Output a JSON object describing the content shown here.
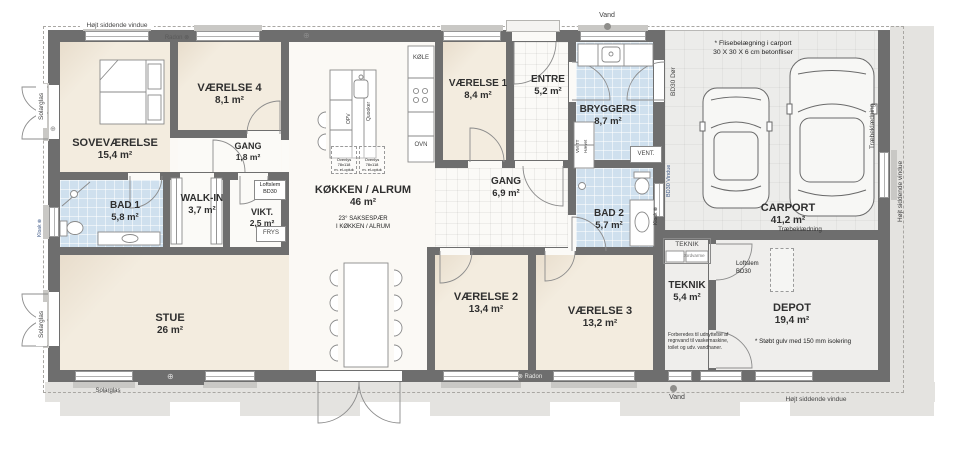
{
  "plan": {
    "rooms": [
      {
        "name": "SOVEVÆRELSE",
        "area": "15,4 m²"
      },
      {
        "name": "VÆRELSE 4",
        "area": "8,1 m²"
      },
      {
        "name": "GANG",
        "area": "1,8 m²"
      },
      {
        "name": "BAD 1",
        "area": "5,8 m²"
      },
      {
        "name": "WALK-IN",
        "area": "3,7 m²"
      },
      {
        "name": "VIKT.",
        "area": "2,5 m²"
      },
      {
        "name": "STUE",
        "area": "26 m²"
      },
      {
        "name": "KØKKEN / ALRUM",
        "area": "46 m²"
      },
      {
        "name": "VÆRELSE 1",
        "area": "8,4 m²"
      },
      {
        "name": "ENTRE",
        "area": "5,2 m²"
      },
      {
        "name": "BRYGGERS",
        "area": "8,7 m²"
      },
      {
        "name": "GANG",
        "area": "6,9 m²"
      },
      {
        "name": "BAD 2",
        "area": "5,7 m²"
      },
      {
        "name": "VÆRELSE 2",
        "area": "13,4 m²"
      },
      {
        "name": "VÆRELSE 3",
        "area": "13,2 m²"
      },
      {
        "name": "CARPORT",
        "area": "41,2 m²"
      },
      {
        "name": "TEKNIK",
        "area": "5,4 m²"
      },
      {
        "name": "DEPOT",
        "area": "19,4 m²"
      }
    ],
    "annotations": {
      "hoejt_siddende_vindue": "Højt siddende vindue",
      "vand": "Vand",
      "radon_top": "Radon ⊗",
      "radon_bottom": "⊗ Radon",
      "solarglas": "Solarglas",
      "bd30_doer": "BD30 Dør",
      "bd30_vindue": "BD30 Vindue",
      "kloak": "Kloak ⊗",
      "traebeklaedning": "Træbeklædning",
      "carport_note_1": "* Flisebelægning i carport",
      "carport_note_2": "30 X 30 X 6 cm betonfliser",
      "depot_note": "* Støbt gulv med 150 mm isolering",
      "rain_note_1": "Forberedes til udnyttelse af",
      "rain_note_2": "regnvand til vaskemaskine,",
      "rain_note_3": "toilet og udv. vandhaner.",
      "truss_note_1": "23° SAKSESPÆR",
      "truss_note_2": "I KØKKEN / ALRUM",
      "loftslem_1": "Loftslem",
      "loftslem_2": "BD30",
      "ovenlys_1": "Ovenlys",
      "ovenlys_2": "78x118",
      "ovenlys_3": "m. el-opluk",
      "frys": "FRYS",
      "koele": "KØLE",
      "ovn": "OVN",
      "vent": "VENT.",
      "opv": "OPV",
      "quooker": "Quooker",
      "vm_tt": "VM TT",
      "haevet": "Hævet",
      "teknik_unit": "TEKNIK",
      "jordvarme": "Jordvarme",
      "circle_symbol": "⊕"
    },
    "colors": {
      "wall": "#6e6e6e",
      "wet_room": "#cfe0ee",
      "room_floor": "#f2eade",
      "carport_floor": "#ececea",
      "ground": "#e4e3e0"
    }
  }
}
